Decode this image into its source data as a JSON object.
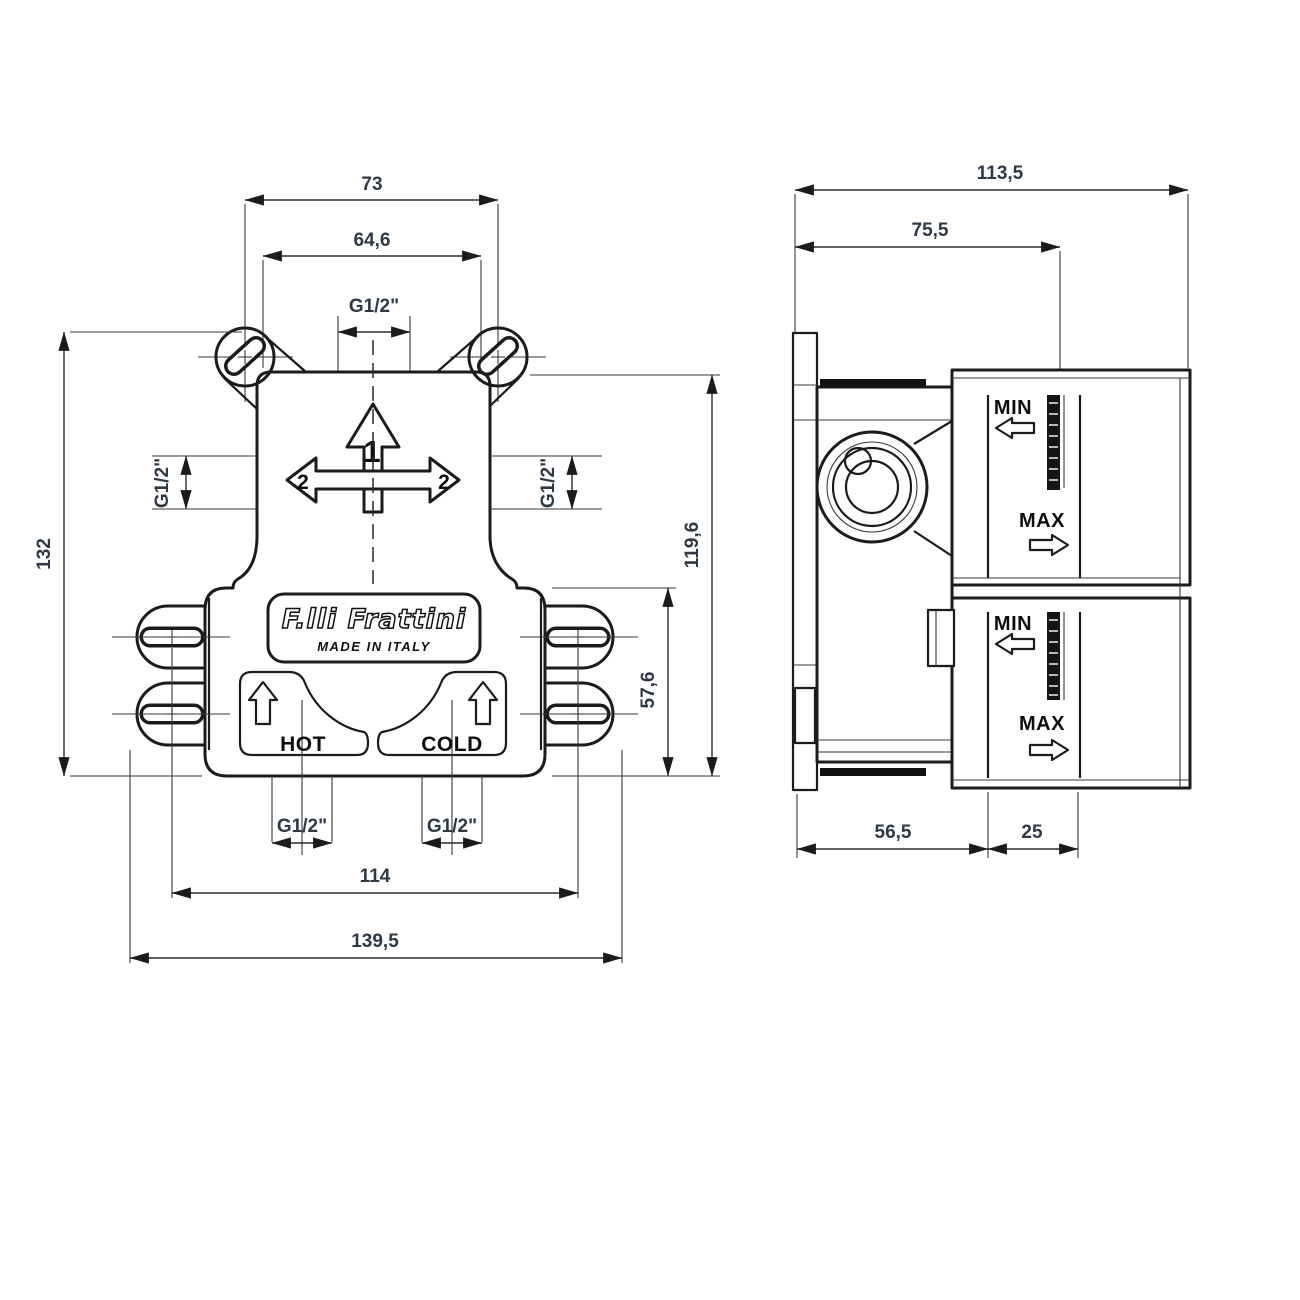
{
  "front": {
    "dim_73": "73",
    "dim_64_6": "64,6",
    "thread_top": "G1/2\"",
    "thread_left": "G1/2\"",
    "thread_right": "G1/2\"",
    "dim_132": "132",
    "dim_119_6": "119,6",
    "dim_57_6": "57,6",
    "thread_hot": "G1/2\"",
    "thread_cold": "G1/2\"",
    "dim_114": "114",
    "dim_139_5": "139,5",
    "brand": "F.lli Frattini",
    "origin": "MADE IN ITALY",
    "hot": "HOT",
    "cold": "COLD",
    "outlet_num": "1",
    "side_num_left": "2",
    "side_num_right": "2"
  },
  "side": {
    "dim_113_5": "113,5",
    "dim_75_5": "75,5",
    "dim_56_5": "56,5",
    "dim_25": "25",
    "min_upper": "MIN",
    "max_upper": "MAX",
    "min_lower": "MIN",
    "max_lower": "MAX"
  },
  "colors": {
    "line": "#1b1b1b",
    "dim_text": "#2d3a46",
    "label_text": "#0d0d0d",
    "background": "#ffffff"
  }
}
